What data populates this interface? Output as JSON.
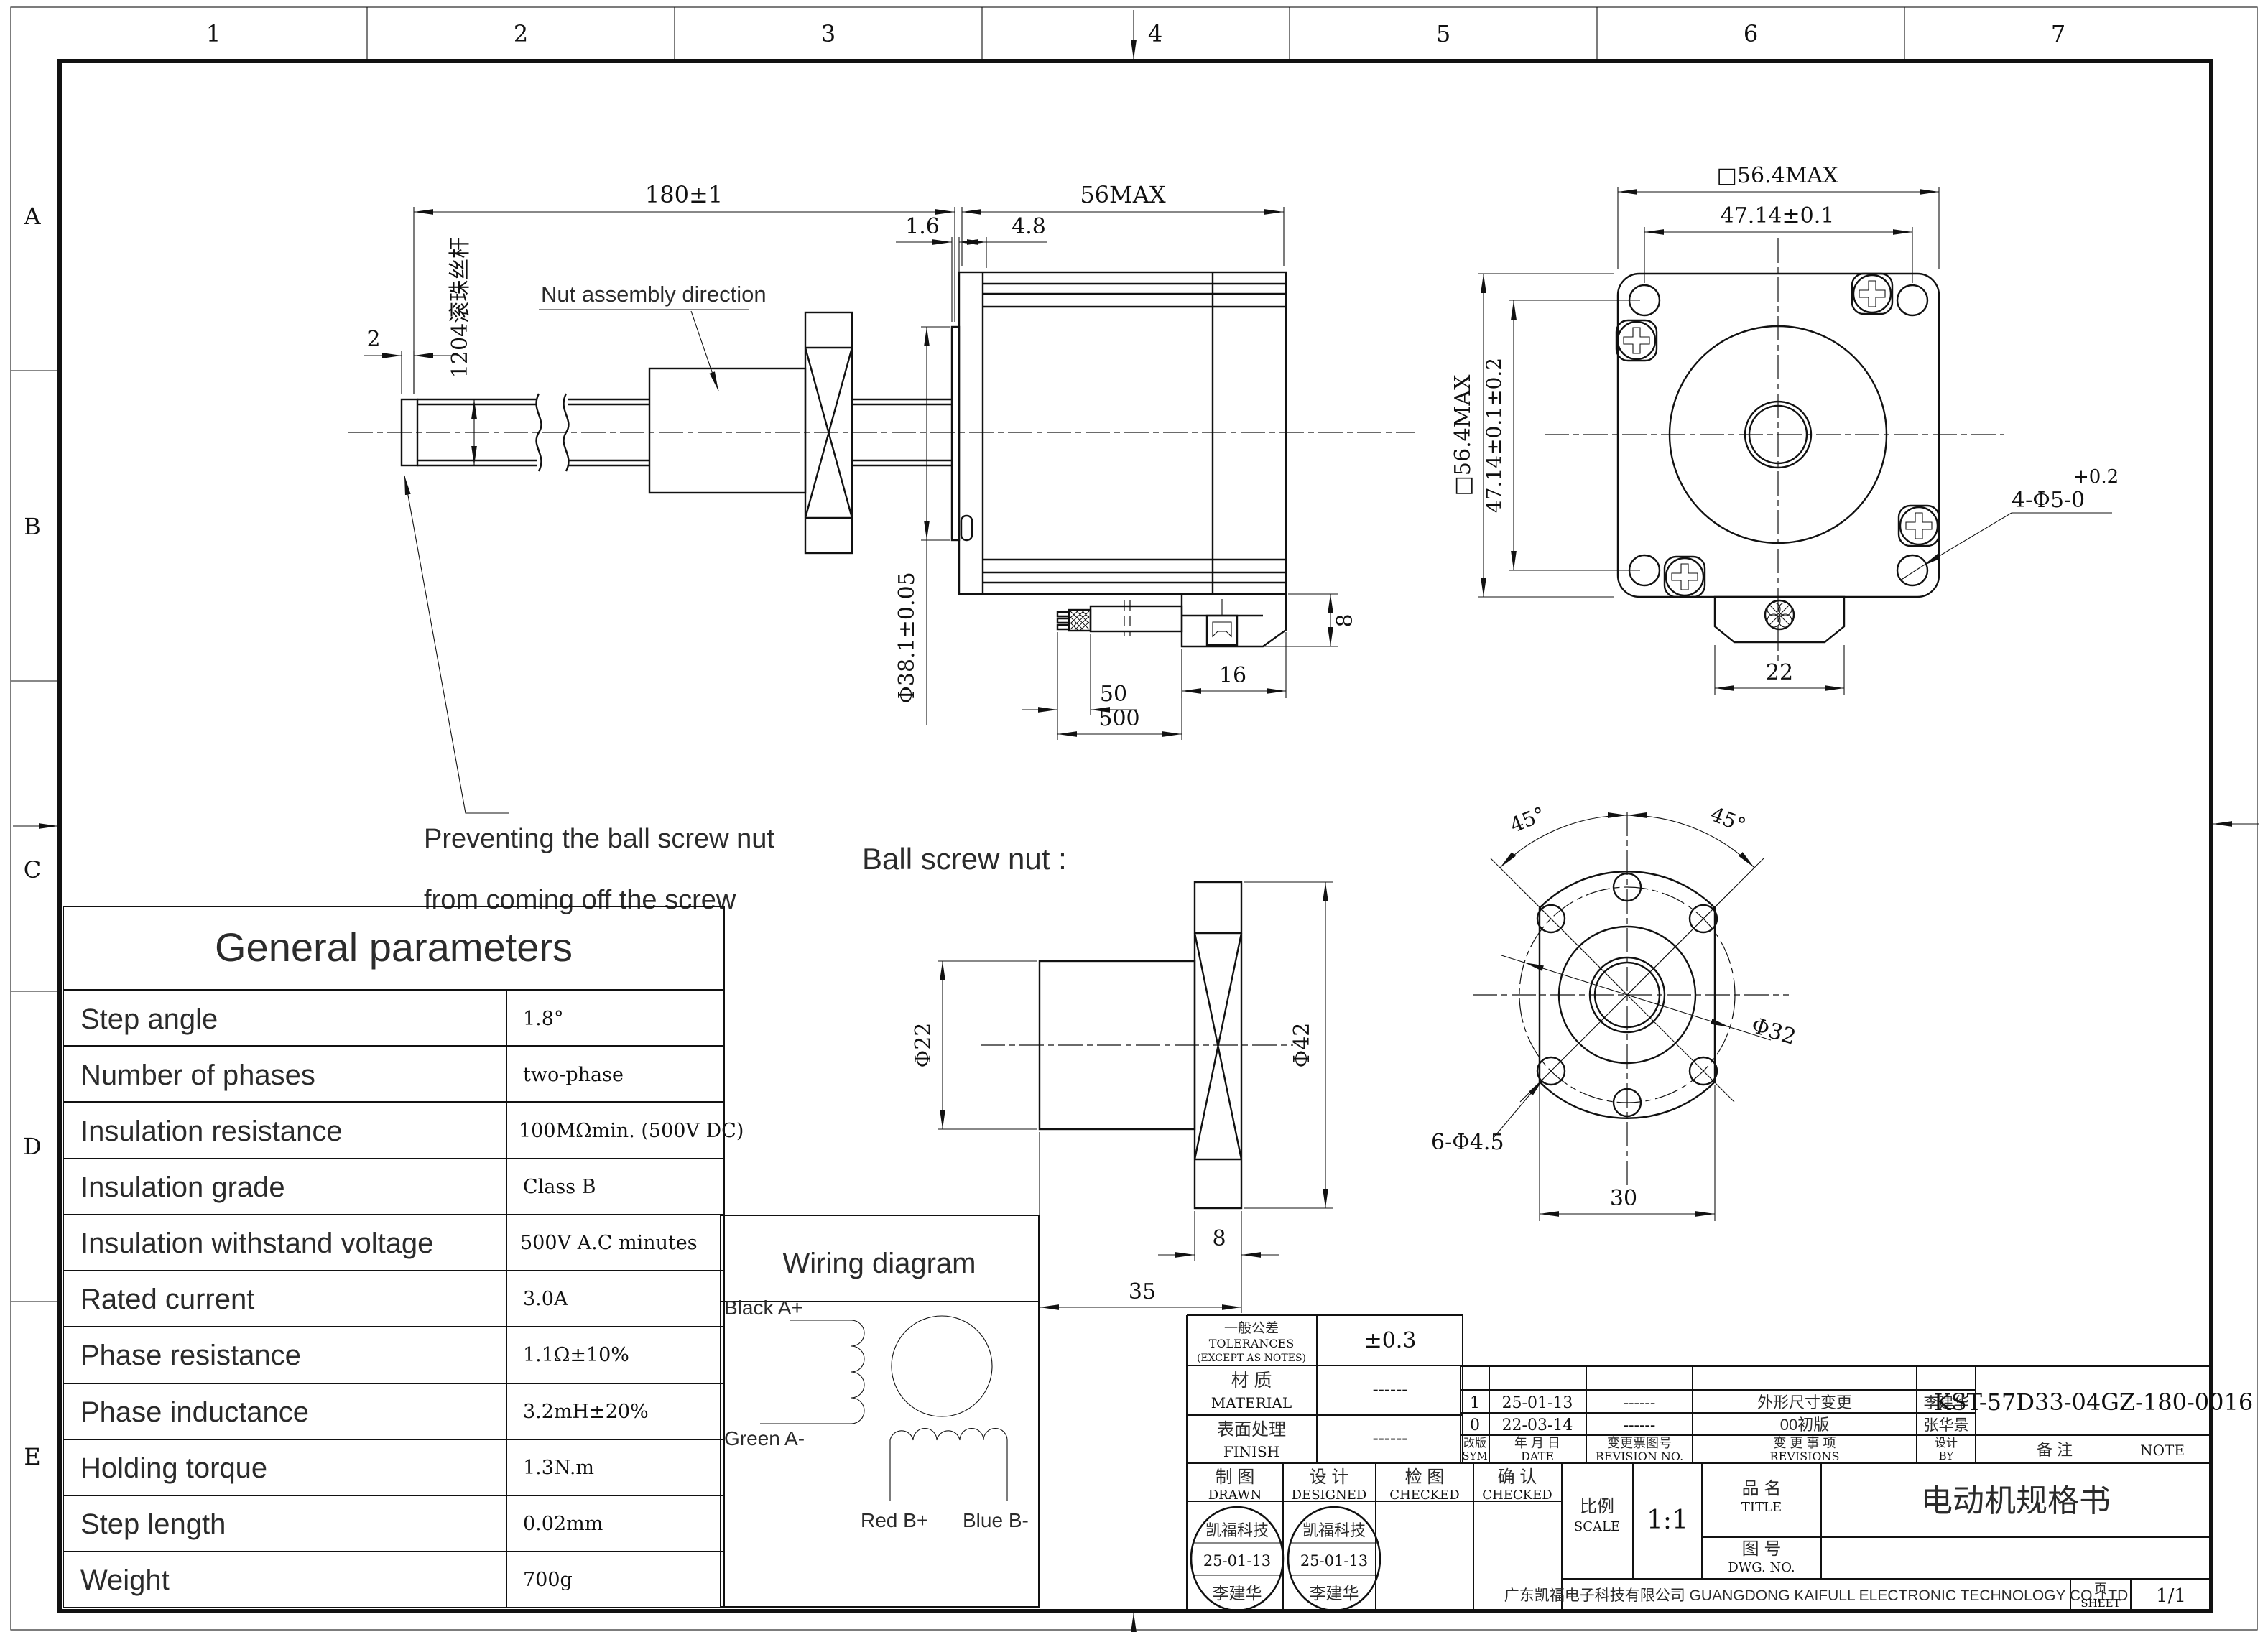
{
  "sheet": {
    "zones_top": [
      "1",
      "2",
      "3",
      "4",
      "5",
      "6",
      "7"
    ],
    "zones_left": [
      "A",
      "B",
      "C",
      "D",
      "E"
    ]
  },
  "side_view": {
    "dim_180": "180±1",
    "dim_56": "56MAX",
    "dim_1_6": "1.6",
    "dim_4_8": "4.8",
    "dim_2": "2",
    "screw_label": "1204滚珠丝杆",
    "nut_dir": "Nut assembly direction",
    "note_line1": "Preventing the ball screw nut",
    "note_line2": "from coming off the screw",
    "dim_shaft": "Φ38.1±0.05",
    "dim_50": "50",
    "dim_500": "500",
    "dim_16": "16",
    "dim_8": "8"
  },
  "front_view": {
    "dim_sq_top": "□56.4MAX",
    "dim_4714_top": "47.14±0.1",
    "dim_sq_left": "□56.4MAX",
    "dim_4714_left": "47.14±0.1±0.2",
    "holes_tol": "+0.2",
    "holes": "4-Φ5-0",
    "dim_22": "22"
  },
  "nut_view": {
    "title": "Ball screw nut :",
    "dim_d22": "Φ22",
    "dim_d42": "Φ42",
    "dim_8": "8",
    "dim_35": "35",
    "angle_left": "45°",
    "angle_right": "45°",
    "dim_d32": "Φ32",
    "holes": "6-Φ4.5",
    "dim_30": "30"
  },
  "wiring": {
    "title": "Wiring diagram",
    "black": "Black A+",
    "green": "Green A-",
    "red": "Red B+",
    "blue": "Blue B-"
  },
  "parameters": {
    "title": "General parameters",
    "rows": [
      {
        "label": "Step angle",
        "value": "1.8°"
      },
      {
        "label": "Number of phases",
        "value": "two-phase"
      },
      {
        "label": "Insulation resistance",
        "value": "100MΩmin. (500V DC)"
      },
      {
        "label": "Insulation grade",
        "value": "Class B"
      },
      {
        "label": "Insulation withstand voltage",
        "value": "500V A.C minutes"
      },
      {
        "label": "Rated current",
        "value": "3.0A"
      },
      {
        "label": "Phase resistance",
        "value": "1.1Ω±10%"
      },
      {
        "label": "Phase inductance",
        "value": "3.2mH±20%"
      },
      {
        "label": "Holding torque",
        "value": "1.3N.m"
      },
      {
        "label": "Step length",
        "value": "0.02mm"
      },
      {
        "label": "Weight",
        "value": "700g"
      }
    ]
  },
  "title_block": {
    "tol_cn": "一般公差",
    "tol_en": "TOLERANCES",
    "tol_note": "(EXCEPT AS NOTES)",
    "tol_value": "±0.3",
    "material_cn": "材  质",
    "material_en": "MATERIAL",
    "material_value": "------",
    "finish_cn": "表面处理",
    "finish_en": "FINISH",
    "finish_value": "------",
    "rev_header": {
      "sym_cn": "改版",
      "sym_en": "SYM",
      "date_cn": "年 月 日",
      "date_en": "DATE",
      "no_cn": "变更票图号",
      "no_en": "REVISION NO.",
      "rev_cn": "变 更 事 项",
      "rev_en": "REVISIONS",
      "by_cn": "设计",
      "by_en": "BY",
      "note_cn": "备    注",
      "note_en": "NOTE"
    },
    "revisions": [
      {
        "sym": "1",
        "date": "25-01-13",
        "no": "------",
        "desc": "外形尺寸变更",
        "by": "李建华"
      },
      {
        "sym": "0",
        "date": "22-03-14",
        "no": "------",
        "desc": "00初版",
        "by": "张华景"
      }
    ],
    "note_value": "KST-57D33-04GZ-180-0016",
    "drawn_cn": "制 图",
    "drawn_en": "DRAWN",
    "designed_cn": "设 计",
    "designed_en": "DESIGNED",
    "checked1_cn": "检 图",
    "checked1_en": "CHECKED",
    "checked2_cn": "确 认",
    "checked2_en": "CHECKED",
    "scale_cn": "比例",
    "scale_en": "SCALE",
    "scale_value": "1:1",
    "title_cn": "品 名",
    "title_en": "TITLE",
    "title_value": "电动机规格书",
    "dwgno_cn": "图 号",
    "dwgno_en": "DWG. NO.",
    "company": "广东凯福电子科技有限公司 GUANGDONG KAIFULL ELECTRONIC TECHNOLOGY CO.,LTD",
    "sheet_cn": "页",
    "sheet_en": "SHEET",
    "sheet_value": "1/1",
    "stamp": {
      "line1": "凯福科技",
      "line2": "25-01-13",
      "line3": "李建华"
    }
  }
}
